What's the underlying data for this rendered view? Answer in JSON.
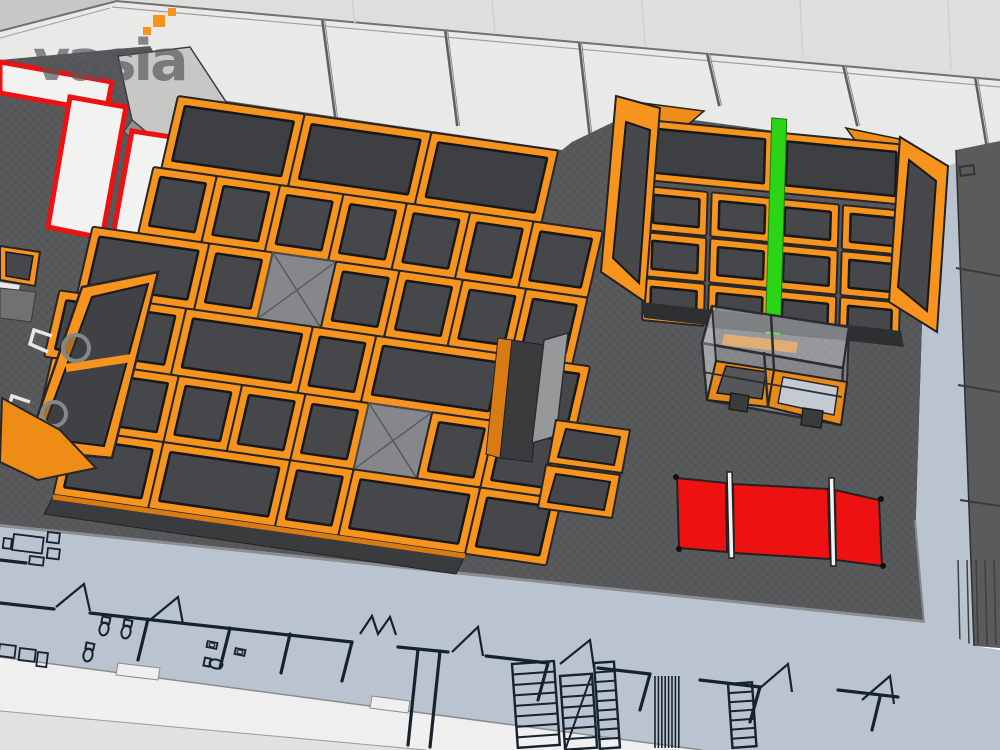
{
  "logo": {
    "text": "vasia",
    "color": "#54575b",
    "pixel_color": "#f7941d",
    "pixels": [
      {
        "x": 143,
        "y": 27,
        "s": 8
      },
      {
        "x": 153,
        "y": 15,
        "s": 12
      },
      {
        "x": 168,
        "y": 8,
        "s": 8
      }
    ]
  },
  "palette": {
    "orange": "#f7941d",
    "orange_dark": "#d97a12",
    "orange_face": "#ef8c15",
    "bed": "#46474a",
    "bed_panel": "#3e3f42",
    "pyramid": "#85878a",
    "platform": "#57585a",
    "platform_edge": "#8b8d90",
    "floor_blue": "#bac4d0",
    "wall_light": "#e9e9e7",
    "wall_shade": "#dededc",
    "wall_corner": "#c8c8c6",
    "white_band": "#eeefee",
    "red": "#ee1111",
    "green": "#2bd414",
    "cad_line": "#16222e",
    "right_wall": "#5a5b5d",
    "glass": "rgba(238,243,248,0.38)"
  },
  "structures": {
    "grids": [
      {
        "target": "main-grid",
        "matrix": [
          0.99,
          0.142,
          -0.225,
          0.974,
          178,
          96
        ],
        "frame": 9,
        "rows": [
          {
            "v": 0,
            "h": 74,
            "cells": [
              {
                "u": 0,
                "w": 128,
                "t": "panel"
              },
              {
                "u": 128,
                "w": 128,
                "t": "panel"
              },
              {
                "u": 256,
                "w": 128,
                "t": "panel"
              }
            ]
          },
          {
            "v": 74,
            "h": 68,
            "cells": [
              {
                "u": -8,
                "w": 64
              },
              {
                "u": 56,
                "w": 64
              },
              {
                "u": 120,
                "w": 64
              },
              {
                "u": 184,
                "w": 64
              },
              {
                "u": 248,
                "w": 64
              },
              {
                "u": 312,
                "w": 64
              },
              {
                "u": 376,
                "w": 70
              }
            ]
          },
          {
            "v": 142,
            "h": 68,
            "cells": [
              {
                "u": -54,
                "w": 118
              },
              {
                "u": 64,
                "w": 64
              },
              {
                "u": 128,
                "w": 64,
                "t": "pyramid"
              },
              {
                "u": 192,
                "w": 64
              },
              {
                "u": 256,
                "w": 64
              },
              {
                "u": 320,
                "w": 64
              },
              {
                "u": 384,
                "w": 62
              }
            ]
          },
          {
            "v": 210,
            "h": 68,
            "cells": [
              {
                "u": -72,
                "w": 64
              },
              {
                "u": -8,
                "w": 64
              },
              {
                "u": 56,
                "w": 128
              },
              {
                "u": 184,
                "w": 64
              },
              {
                "u": 248,
                "w": 136
              },
              {
                "u": 384,
                "w": 80
              }
            ]
          },
          {
            "v": 278,
            "h": 68,
            "cells": [
              {
                "u": -64,
                "w": 128
              },
              {
                "u": 64,
                "w": 64
              },
              {
                "u": 128,
                "w": 64
              },
              {
                "u": 192,
                "w": 64
              },
              {
                "u": 256,
                "w": 64,
                "t": "pyramid"
              },
              {
                "u": 320,
                "w": 64
              },
              {
                "u": 384,
                "w": 72
              }
            ]
          },
          {
            "v": 346,
            "h": 68,
            "cells": [
              {
                "u": -32,
                "w": 96
              },
              {
                "u": 64,
                "w": 128
              },
              {
                "u": 192,
                "w": 64
              },
              {
                "u": 256,
                "w": 128
              },
              {
                "u": 384,
                "w": 82
              }
            ]
          }
        ]
      },
      {
        "target": "right-grid",
        "matrix": [
          0.995,
          0.096,
          -0.03,
          1,
          648,
          120
        ],
        "frame": 8,
        "rows": [
          {
            "v": 0,
            "h": 60,
            "cells": [
              {
                "u": 0,
                "w": 126,
                "t": "panel"
              },
              {
                "u": 132,
                "w": 126,
                "t": "panel"
              }
            ]
          },
          {
            "v": 66,
            "h": 44,
            "cells": [
              {
                "u": 0,
                "w": 62
              },
              {
                "u": 66,
                "w": 62
              },
              {
                "u": 132,
                "w": 62
              },
              {
                "u": 198,
                "w": 60
              }
            ]
          },
          {
            "v": 112,
            "h": 44,
            "cells": [
              {
                "u": 0,
                "w": 62
              },
              {
                "u": 66,
                "w": 62
              },
              {
                "u": 132,
                "w": 62
              },
              {
                "u": 198,
                "w": 60
              }
            ]
          },
          {
            "v": 158,
            "h": 42,
            "cells": [
              {
                "u": 0,
                "w": 62
              },
              {
                "u": 66,
                "w": 62
              },
              {
                "u": 132,
                "w": 62
              },
              {
                "u": 198,
                "w": 60
              }
            ]
          }
        ],
        "stripe": {
          "u": 124,
          "v": -14,
          "w": 15,
          "h": 216
        }
      }
    ]
  },
  "cad": {
    "walls": [
      [
        0,
        603,
        54,
        609
      ],
      [
        90,
        613,
        352,
        642
      ],
      [
        148,
        619,
        138,
        660
      ],
      [
        230,
        628,
        220,
        668
      ],
      [
        290,
        634,
        281,
        673
      ],
      [
        352,
        642,
        342,
        681
      ],
      [
        398,
        647,
        448,
        652
      ],
      [
        418,
        649,
        408,
        745
      ],
      [
        440,
        651,
        430,
        747
      ],
      [
        486,
        656,
        548,
        663
      ],
      [
        548,
        663,
        538,
        700
      ],
      [
        598,
        668,
        650,
        674
      ],
      [
        650,
        674,
        640,
        710
      ],
      [
        700,
        680,
        760,
        687
      ],
      [
        760,
        687,
        750,
        722
      ],
      [
        838,
        690,
        898,
        697
      ],
      [
        880,
        697,
        872,
        730
      ],
      [
        0,
        560,
        26,
        563
      ]
    ],
    "doors": [
      [
        56,
        607,
        84,
        584,
        90,
        611
      ],
      [
        150,
        620,
        178,
        597,
        183,
        624
      ],
      [
        360,
        634,
        372,
        616,
        378,
        634,
        390,
        617,
        396,
        635
      ],
      [
        452,
        652,
        478,
        627,
        483,
        656
      ],
      [
        560,
        664,
        590,
        640,
        594,
        668
      ],
      [
        760,
        688,
        788,
        664,
        792,
        692
      ],
      [
        862,
        700,
        890,
        676,
        894,
        704
      ]
    ],
    "toilets": [
      [
        104,
        629,
        12
      ],
      [
        126,
        632,
        12
      ],
      [
        216,
        664,
        -78
      ],
      [
        88,
        655,
        12
      ]
    ],
    "sinks": [
      [
        212,
        645,
        -78
      ],
      [
        240,
        652,
        -78
      ]
    ],
    "ladders": [
      {
        "x": 512,
        "y": 664,
        "w": 42,
        "h": 84,
        "r": 7,
        "tilt": -4,
        "diag": false
      },
      {
        "x": 560,
        "y": 676,
        "w": 32,
        "h": 74,
        "r": 6,
        "tilt": -4,
        "diag": true
      },
      {
        "x": 594,
        "y": 663,
        "w": 20,
        "h": 86,
        "r": 8,
        "tilt": -4,
        "diag": false
      },
      {
        "x": 728,
        "y": 684,
        "w": 24,
        "h": 64,
        "r": 6,
        "tilt": -4,
        "diag": false
      }
    ],
    "bundle": {
      "x": 655,
      "y": 676,
      "n": 8,
      "dx": 3.4,
      "h": 72
    },
    "furniture": [
      [
        14,
        534,
        30,
        16,
        7
      ],
      [
        48,
        532,
        12,
        10,
        7
      ],
      [
        48,
        548,
        12,
        10,
        7
      ],
      [
        4,
        538,
        8,
        10,
        7
      ],
      [
        30,
        556,
        14,
        8,
        7
      ],
      [
        0,
        644,
        16,
        12,
        7
      ],
      [
        20,
        648,
        16,
        12,
        7
      ],
      [
        38,
        652,
        10,
        14,
        7
      ]
    ],
    "ribs": {
      "x0": 958,
      "dx": 9,
      "n": 5,
      "y1": 560,
      "y2": 645
    }
  },
  "posts": [
    [
      323,
      20,
      336,
      118
    ],
    [
      446,
      31,
      458,
      126
    ],
    [
      580,
      43,
      592,
      150
    ],
    [
      708,
      54,
      720,
      106
    ],
    [
      844,
      66,
      858,
      126
    ],
    [
      976,
      78,
      988,
      150
    ]
  ],
  "wall_joints": [
    [
      352,
      0,
      355,
      24
    ],
    [
      492,
      0,
      495,
      34
    ],
    [
      642,
      0,
      645,
      46
    ],
    [
      800,
      0,
      803,
      58
    ],
    [
      948,
      0,
      951,
      70
    ]
  ]
}
